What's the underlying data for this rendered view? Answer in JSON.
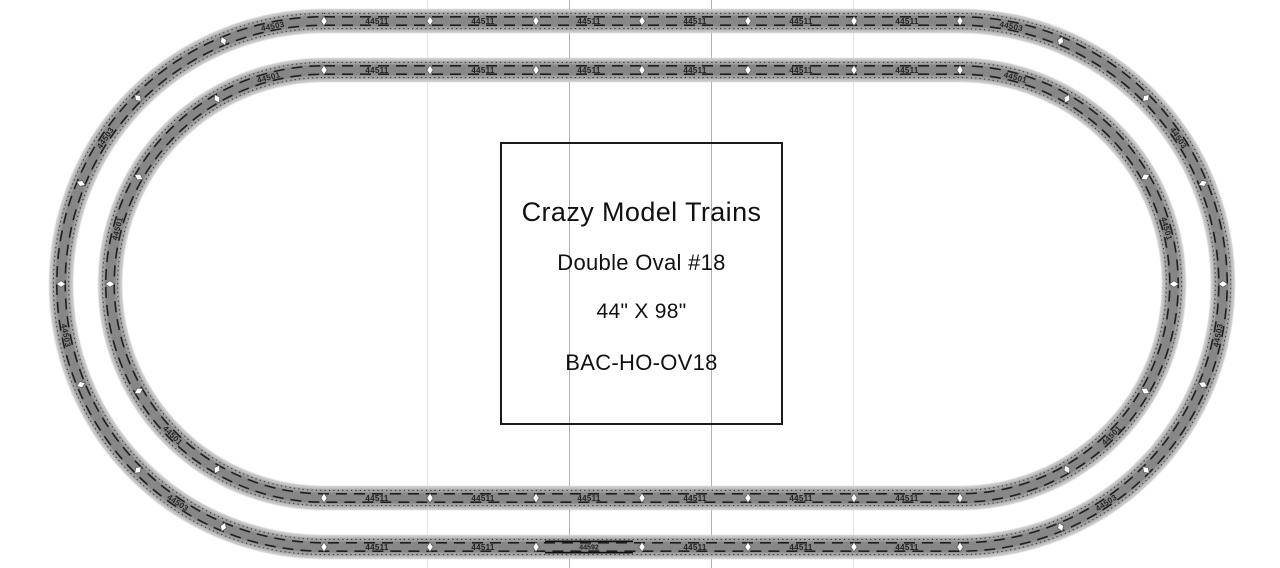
{
  "canvas": {
    "width": 1280,
    "height": 568,
    "background": "#ffffff"
  },
  "title_box": {
    "line1": "Crazy Model Trains",
    "line2": "Double Oval #18",
    "line3": "44\" X 98\"",
    "line4": "BAC-HO-OV18"
  },
  "gridlines": [
    {
      "x": 427,
      "color": "#e6e6e6"
    },
    {
      "x": 569,
      "color": "#b2b2b2"
    },
    {
      "x": 711,
      "color": "#b2b2b2"
    },
    {
      "x": 853,
      "color": "#e3e3e3"
    }
  ],
  "track_plan": {
    "type": "double-oval",
    "center_y": 284,
    "curve_center_left_x": 324,
    "curve_center_right_x": 960,
    "ovals": [
      {
        "name": "outer",
        "radius": 263,
        "straight_pieces": 6,
        "curve_pieces_per_end": 8,
        "straight_label": "44511",
        "curve_label": "44503",
        "rerailer": {
          "present": true,
          "side": "bottom",
          "piece_index": 2,
          "label": "44592"
        }
      },
      {
        "name": "inner",
        "radius": 214,
        "straight_pieces": 6,
        "curve_pieces_per_end": 6,
        "straight_label": "44511",
        "curve_label": "44501",
        "rerailer": {
          "present": false
        }
      }
    ],
    "colors": {
      "roadbed_edge": "#c7c7c7",
      "roadbed": "#a2a2a2",
      "ballast_center": "#878787",
      "rail": "#1f1f1f",
      "tie_dots": "#2e2e2e",
      "joint_fill": "#ffffff",
      "joint_stroke": "#5f5f5f",
      "piece_label_color": "#151515",
      "rerailer_line": "#111111"
    }
  }
}
